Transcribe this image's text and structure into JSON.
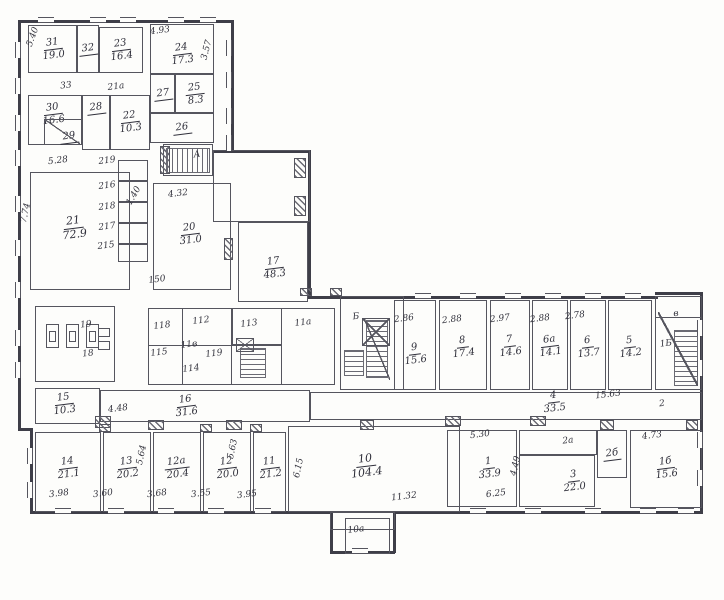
{
  "plan": {
    "ink": "#55555e",
    "paper": "#fdfdfb",
    "rooms": [
      {
        "n": "31",
        "a": "19.0",
        "x": 28,
        "y": 25,
        "w": 49,
        "h": 48
      },
      {
        "n": "32",
        "x": 77,
        "y": 25,
        "w": 22,
        "h": 48
      },
      {
        "n": "23",
        "a": "16.4",
        "x": 99,
        "y": 27,
        "w": 44,
        "h": 46
      },
      {
        "n": "24",
        "a": "17.3",
        "x": 150,
        "y": 24,
        "w": 64,
        "h": 50,
        "ly": 54
      },
      {
        "n": "25",
        "a": "8.3",
        "x": 175,
        "y": 74,
        "w": 39,
        "h": 39
      },
      {
        "n": "27",
        "x": 150,
        "y": 74,
        "w": 25,
        "h": 39
      },
      {
        "n": "26",
        "x": 150,
        "y": 113,
        "w": 64,
        "h": 30
      },
      {
        "n": "30",
        "a": "16.6",
        "x": 28,
        "y": 95,
        "w": 54,
        "h": 50,
        "lx": 53,
        "ly": 114
      },
      {
        "n": "29",
        "x": 44,
        "y": 119,
        "w": 38,
        "h": 26,
        "lx": 69,
        "ly": 137
      },
      {
        "n": "28",
        "x": 82,
        "y": 95,
        "w": 28,
        "h": 55,
        "ly": 108
      },
      {
        "n": "22",
        "a": "10.3",
        "x": 110,
        "y": 95,
        "w": 40,
        "h": 55,
        "ly": 122
      },
      {
        "n": "21",
        "a": "72.9",
        "x": 30,
        "y": 172,
        "w": 100,
        "h": 118,
        "lx": 74,
        "ly": 228,
        "fs": 11
      },
      {
        "n": "20",
        "a": "31.0",
        "x": 153,
        "y": 183,
        "w": 78,
        "h": 107,
        "lx": 190,
        "ly": 234
      },
      {
        "n": "17",
        "a": "48.3",
        "x": 238,
        "y": 222,
        "w": 70,
        "h": 80,
        "lx": 274,
        "ly": 268
      },
      {
        "n": "9",
        "a": "15.6",
        "x": 394,
        "y": 300,
        "w": 42,
        "h": 90,
        "ly": 354
      },
      {
        "n": "8",
        "a": "17.4",
        "x": 439,
        "y": 300,
        "w": 48,
        "h": 90,
        "ly": 347
      },
      {
        "n": "7",
        "a": "14.6",
        "x": 490,
        "y": 300,
        "w": 40,
        "h": 90,
        "ly": 346
      },
      {
        "n": "6а",
        "a": "14.1",
        "x": 532,
        "y": 300,
        "w": 36,
        "h": 90,
        "ly": 346
      },
      {
        "n": "6",
        "a": "13.7",
        "x": 570,
        "y": 300,
        "w": 36,
        "h": 90,
        "ly": 347
      },
      {
        "n": "5",
        "a": "14.2",
        "x": 608,
        "y": 300,
        "w": 44,
        "h": 90,
        "ly": 347
      },
      {
        "n": "4",
        "a": "33.5",
        "x": 310,
        "y": 392,
        "w": 392,
        "h": 28,
        "lx": 554,
        "ly": 402
      },
      {
        "n": "16",
        "a": "31.6",
        "x": 100,
        "y": 390,
        "w": 210,
        "h": 32,
        "lx": 186,
        "ly": 406
      },
      {
        "n": "15",
        "a": "10.3",
        "x": 35,
        "y": 388,
        "w": 65,
        "h": 36,
        "lx": 64,
        "ly": 404
      },
      {
        "n": "14",
        "a": "21.1",
        "x": 35,
        "y": 432,
        "w": 66,
        "h": 80,
        "ly": 468
      },
      {
        "n": "13",
        "a": "20.2",
        "x": 103,
        "y": 432,
        "w": 48,
        "h": 80,
        "ly": 468
      },
      {
        "n": "12а",
        "a": "20.4",
        "x": 153,
        "y": 432,
        "w": 48,
        "h": 80,
        "ly": 468
      },
      {
        "n": "12",
        "a": "20.0",
        "x": 203,
        "y": 432,
        "w": 48,
        "h": 80,
        "ly": 468
      },
      {
        "n": "11",
        "a": "21.2",
        "x": 253,
        "y": 432,
        "w": 33,
        "h": 80,
        "ly": 468
      },
      {
        "n": "10",
        "a": "104.4",
        "x": 288,
        "y": 426,
        "w": 172,
        "h": 86,
        "lx": 366,
        "ly": 466,
        "fs": 11
      },
      {
        "n": "1",
        "a": "33.9",
        "x": 447,
        "y": 430,
        "w": 70,
        "h": 77,
        "lx": 489,
        "ly": 468
      },
      {
        "n": "3",
        "a": "22.0",
        "x": 519,
        "y": 455,
        "w": 76,
        "h": 52,
        "lx": 574,
        "ly": 481
      },
      {
        "n": "2б",
        "x": 597,
        "y": 430,
        "w": 30,
        "h": 48
      },
      {
        "n": "1б",
        "a": "15.6",
        "x": 630,
        "y": 430,
        "w": 72,
        "h": 78,
        "ly": 468
      }
    ],
    "boxes": [
      {
        "x": 118,
        "y": 160,
        "w": 30,
        "h": 21
      },
      {
        "x": 118,
        "y": 181,
        "w": 30,
        "h": 21
      },
      {
        "x": 118,
        "y": 202,
        "w": 30,
        "h": 21
      },
      {
        "x": 118,
        "y": 223,
        "w": 30,
        "h": 21
      },
      {
        "x": 118,
        "y": 244,
        "w": 30,
        "h": 18
      },
      {
        "x": 35,
        "y": 306,
        "w": 80,
        "h": 76
      },
      {
        "x": 148,
        "y": 308,
        "w": 187,
        "h": 77
      },
      {
        "x": 182,
        "y": 308,
        "w": 50,
        "h": 77
      },
      {
        "x": 232,
        "y": 308,
        "w": 50,
        "h": 37
      },
      {
        "x": 148,
        "y": 345,
        "w": 134,
        "h": 40
      },
      {
        "x": 163,
        "y": 144,
        "w": 50,
        "h": 32
      },
      {
        "x": 340,
        "y": 296,
        "w": 64,
        "h": 94
      },
      {
        "x": 655,
        "y": 296,
        "w": 47,
        "h": 94
      },
      {
        "x": 655,
        "y": 296,
        "w": 47,
        "h": 22
      },
      {
        "x": 519,
        "y": 430,
        "w": 78,
        "h": 25
      },
      {
        "x": 213,
        "y": 150,
        "w": 97,
        "h": 72
      },
      {
        "x": 330,
        "y": 512,
        "w": 65,
        "h": 18
      },
      {
        "x": 345,
        "y": 518,
        "w": 45,
        "h": 36
      },
      {
        "x": 98,
        "y": 328,
        "w": 12,
        "h": 9
      },
      {
        "x": 98,
        "y": 341,
        "w": 12,
        "h": 9
      }
    ],
    "labels": [
      {
        "t": "4.93",
        "x": 160,
        "y": 31
      },
      {
        "t": "3.57",
        "x": 207,
        "y": 50,
        "r": -75
      },
      {
        "t": "5.40",
        "x": 33,
        "y": 37,
        "r": -70
      },
      {
        "t": "33",
        "x": 66,
        "y": 86
      },
      {
        "t": "21а",
        "x": 116,
        "y": 87
      },
      {
        "t": "5.28",
        "x": 58,
        "y": 161
      },
      {
        "t": "219",
        "x": 107,
        "y": 161
      },
      {
        "t": "216",
        "x": 107,
        "y": 186
      },
      {
        "t": "218",
        "x": 107,
        "y": 207
      },
      {
        "t": "217",
        "x": 107,
        "y": 227
      },
      {
        "t": "215",
        "x": 106,
        "y": 246
      },
      {
        "t": "1.40",
        "x": 134,
        "y": 196,
        "r": -60
      },
      {
        "t": "7.74",
        "x": 26,
        "y": 213,
        "r": -78
      },
      {
        "t": "4.32",
        "x": 178,
        "y": 194
      },
      {
        "t": "150",
        "x": 157,
        "y": 280
      },
      {
        "t": "А",
        "x": 197,
        "y": 155
      },
      {
        "t": "Б",
        "x": 356,
        "y": 317
      },
      {
        "t": "1Б",
        "x": 666,
        "y": 344
      },
      {
        "t": "в",
        "x": 676,
        "y": 314
      },
      {
        "t": "2.86",
        "x": 404,
        "y": 319
      },
      {
        "t": "2.88",
        "x": 452,
        "y": 320
      },
      {
        "t": "2.97",
        "x": 500,
        "y": 319
      },
      {
        "t": "2.88",
        "x": 540,
        "y": 319
      },
      {
        "t": "2.78",
        "x": 575,
        "y": 316
      },
      {
        "t": "15.63",
        "x": 608,
        "y": 395
      },
      {
        "t": "2",
        "x": 662,
        "y": 404
      },
      {
        "t": "118",
        "x": 162,
        "y": 326
      },
      {
        "t": "112",
        "x": 201,
        "y": 321
      },
      {
        "t": "113",
        "x": 249,
        "y": 324
      },
      {
        "t": "11а",
        "x": 303,
        "y": 323
      },
      {
        "t": "115",
        "x": 159,
        "y": 353
      },
      {
        "t": "11в",
        "x": 189,
        "y": 345
      },
      {
        "t": "119",
        "x": 214,
        "y": 354
      },
      {
        "t": "114",
        "x": 191,
        "y": 369
      },
      {
        "t": "19",
        "x": 86,
        "y": 325
      },
      {
        "t": "18",
        "x": 88,
        "y": 354
      },
      {
        "t": "4.48",
        "x": 118,
        "y": 409
      },
      {
        "t": "5.64",
        "x": 142,
        "y": 455,
        "r": -78
      },
      {
        "t": "5.63",
        "x": 233,
        "y": 449,
        "r": -78
      },
      {
        "t": "3.98",
        "x": 59,
        "y": 494
      },
      {
        "t": "3.60",
        "x": 103,
        "y": 494
      },
      {
        "t": "3.68",
        "x": 157,
        "y": 494
      },
      {
        "t": "3.55",
        "x": 201,
        "y": 494
      },
      {
        "t": "3.95",
        "x": 247,
        "y": 495
      },
      {
        "t": "6.15",
        "x": 299,
        "y": 468,
        "r": -78
      },
      {
        "t": "11.32",
        "x": 404,
        "y": 497
      },
      {
        "t": "10а",
        "x": 356,
        "y": 530
      },
      {
        "t": "5.30",
        "x": 480,
        "y": 435
      },
      {
        "t": "6.25",
        "x": 496,
        "y": 494
      },
      {
        "t": "4.49",
        "x": 516,
        "y": 466,
        "r": -78
      },
      {
        "t": "2а",
        "x": 568,
        "y": 441
      },
      {
        "t": "4.73",
        "x": 652,
        "y": 436
      }
    ],
    "walls": [
      {
        "o": "h",
        "x": 18,
        "y": 20,
        "l": 214
      },
      {
        "o": "v",
        "x": 18,
        "y": 20,
        "l": 408
      },
      {
        "o": "v",
        "x": 231,
        "y": 20,
        "l": 132
      },
      {
        "o": "h",
        "x": 213,
        "y": 150,
        "l": 97
      },
      {
        "o": "v",
        "x": 308,
        "y": 150,
        "l": 148
      },
      {
        "o": "h",
        "x": 308,
        "y": 296,
        "l": 350
      },
      {
        "o": "h",
        "x": 655,
        "y": 292,
        "l": 48
      },
      {
        "o": "v",
        "x": 700,
        "y": 292,
        "l": 222
      },
      {
        "o": "h",
        "x": 395,
        "y": 511,
        "l": 307
      },
      {
        "o": "h",
        "x": 30,
        "y": 511,
        "l": 302
      },
      {
        "o": "v",
        "x": 30,
        "y": 428,
        "l": 86
      },
      {
        "o": "h",
        "x": 18,
        "y": 428,
        "l": 14
      },
      {
        "o": "v",
        "x": 330,
        "y": 511,
        "l": 42
      },
      {
        "o": "v",
        "x": 393,
        "y": 511,
        "l": 42
      },
      {
        "o": "h",
        "x": 330,
        "y": 551,
        "l": 65
      }
    ],
    "windows": [
      {
        "o": "v",
        "x": 15,
        "y": 42
      },
      {
        "o": "v",
        "x": 15,
        "y": 78
      },
      {
        "o": "v",
        "x": 15,
        "y": 115
      },
      {
        "o": "v",
        "x": 15,
        "y": 150
      },
      {
        "o": "v",
        "x": 15,
        "y": 196
      },
      {
        "o": "v",
        "x": 15,
        "y": 240
      },
      {
        "o": "v",
        "x": 15,
        "y": 282
      },
      {
        "o": "v",
        "x": 15,
        "y": 330
      },
      {
        "o": "v",
        "x": 15,
        "y": 362
      },
      {
        "o": "v",
        "x": 226,
        "y": 40
      },
      {
        "o": "v",
        "x": 226,
        "y": 72
      },
      {
        "o": "v",
        "x": 226,
        "y": 108
      },
      {
        "o": "v",
        "x": 226,
        "y": 135
      },
      {
        "o": "h",
        "x": 38,
        "y": 17
      },
      {
        "o": "h",
        "x": 90,
        "y": 17
      },
      {
        "o": "h",
        "x": 120,
        "y": 17
      },
      {
        "o": "h",
        "x": 168,
        "y": 17
      },
      {
        "o": "h",
        "x": 200,
        "y": 17
      },
      {
        "o": "h",
        "x": 415,
        "y": 293
      },
      {
        "o": "h",
        "x": 460,
        "y": 293
      },
      {
        "o": "h",
        "x": 505,
        "y": 293
      },
      {
        "o": "h",
        "x": 545,
        "y": 293
      },
      {
        "o": "h",
        "x": 585,
        "y": 293
      },
      {
        "o": "h",
        "x": 625,
        "y": 293
      },
      {
        "o": "v",
        "x": 697,
        "y": 320
      },
      {
        "o": "v",
        "x": 697,
        "y": 360
      },
      {
        "o": "v",
        "x": 697,
        "y": 432
      },
      {
        "o": "v",
        "x": 697,
        "y": 470
      },
      {
        "o": "h",
        "x": 55,
        "y": 508
      },
      {
        "o": "h",
        "x": 108,
        "y": 508
      },
      {
        "o": "h",
        "x": 158,
        "y": 508
      },
      {
        "o": "h",
        "x": 208,
        "y": 508
      },
      {
        "o": "h",
        "x": 255,
        "y": 508
      },
      {
        "o": "h",
        "x": 470,
        "y": 508
      },
      {
        "o": "h",
        "x": 525,
        "y": 508
      },
      {
        "o": "h",
        "x": 585,
        "y": 508
      },
      {
        "o": "h",
        "x": 640,
        "y": 508
      },
      {
        "o": "h",
        "x": 678,
        "y": 508
      },
      {
        "o": "h",
        "x": 352,
        "y": 548
      },
      {
        "o": "v",
        "x": 27,
        "y": 448
      },
      {
        "o": "v",
        "x": 27,
        "y": 482
      }
    ],
    "hatches": [
      {
        "x": 95,
        "y": 416,
        "w": 16,
        "h": 12
      },
      {
        "x": 148,
        "y": 420,
        "w": 16,
        "h": 10
      },
      {
        "x": 226,
        "y": 420,
        "w": 16,
        "h": 10
      },
      {
        "x": 360,
        "y": 420,
        "w": 14,
        "h": 10
      },
      {
        "x": 445,
        "y": 416,
        "w": 16,
        "h": 10
      },
      {
        "x": 530,
        "y": 416,
        "w": 16,
        "h": 10
      },
      {
        "x": 600,
        "y": 420,
        "w": 14,
        "h": 10
      },
      {
        "x": 686,
        "y": 420,
        "w": 12,
        "h": 10
      },
      {
        "x": 160,
        "y": 146,
        "w": 10,
        "h": 28
      },
      {
        "x": 294,
        "y": 158,
        "w": 12,
        "h": 20
      },
      {
        "x": 294,
        "y": 196,
        "w": 12,
        "h": 20
      },
      {
        "x": 224,
        "y": 238,
        "w": 9,
        "h": 22
      },
      {
        "x": 99,
        "y": 424,
        "w": 12,
        "h": 8
      },
      {
        "x": 200,
        "y": 424,
        "w": 12,
        "h": 8
      },
      {
        "x": 250,
        "y": 424,
        "w": 12,
        "h": 8
      },
      {
        "x": 300,
        "y": 288,
        "w": 12,
        "h": 8
      },
      {
        "x": 330,
        "y": 288,
        "w": 12,
        "h": 8
      }
    ],
    "stripes": [
      {
        "x": 166,
        "y": 148,
        "w": 44,
        "h": 25,
        "d": "v"
      },
      {
        "x": 344,
        "y": 350,
        "w": 20,
        "h": 26,
        "d": "h"
      },
      {
        "x": 366,
        "y": 320,
        "w": 22,
        "h": 58,
        "d": "h"
      },
      {
        "x": 674,
        "y": 330,
        "w": 24,
        "h": 56,
        "d": "h"
      },
      {
        "x": 240,
        "y": 348,
        "w": 26,
        "h": 30,
        "d": "h"
      }
    ],
    "diagonals": [
      {
        "x": 44,
        "y": 119,
        "w": 36,
        "h": 25,
        "f": true
      },
      {
        "x": 364,
        "y": 318,
        "w": 26,
        "h": 62,
        "f": true
      },
      {
        "x": 658,
        "y": 312,
        "w": 40,
        "h": 74,
        "f": true
      }
    ],
    "xboxes": [
      {
        "x": 362,
        "y": 318,
        "w": 28,
        "h": 28
      },
      {
        "x": 236,
        "y": 338,
        "w": 18,
        "h": 14
      }
    ],
    "fixtures": [
      {
        "x": 46,
        "y": 324
      },
      {
        "x": 66,
        "y": 324
      },
      {
        "x": 86,
        "y": 324
      }
    ]
  }
}
